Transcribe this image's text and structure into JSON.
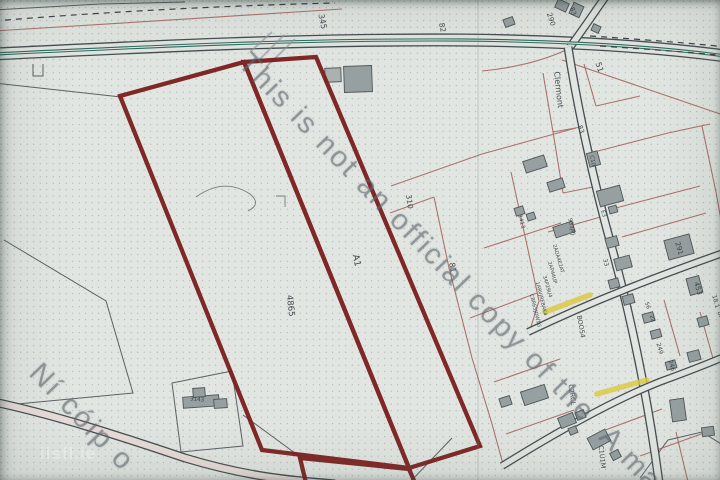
{
  "watermark": {
    "line1": "This is not an official copy of the",
    "line1_continued": "A ma",
    "line2": "Ní cóip o",
    "logo": "ilsfl.ie"
  },
  "map": {
    "colors": {
      "paper": "#e2e6e2",
      "dot": "#8a948c",
      "road_line": "#464d51",
      "road_center": "#2e6b5e",
      "road_inner_tint": "#e7dcd8",
      "property_line": "#a8655f",
      "thin_line": "#5b6165",
      "contour": "#757d80",
      "gray_mark": "#8f979b",
      "building_fill": "#97a0a1",
      "building_fill_light": "#aab1b0",
      "building_stroke": "#4e5558",
      "red_boundary": "#7b1e1d",
      "highlight": "#ddc83e",
      "label": "#323a3e",
      "dash_line": "#3a4043"
    },
    "roads": [
      {
        "name": "main-road",
        "d": "M -6,54 C 140,47 300,39 460,40 C 575,41 665,48 726,56",
        "w": 13
      },
      {
        "name": "top-branch-road",
        "d": "M 606,-4 C 596,10 584,28 570,47",
        "w": 8.5
      },
      {
        "name": "village-street",
        "d": "M 568,47 C 577,105 593,180 613,252 C 631,318 647,392 659,482",
        "w": 9
      },
      {
        "name": "upper-cross-street",
        "d": "M 528,332 C 595,300 655,277 726,252",
        "w": 8
      },
      {
        "name": "lower-cross-street",
        "d": "M 502,466 C 560,430 618,398 662,381 C 692,370 712,362 726,356",
        "w": 8
      },
      {
        "name": "bottom-left-road",
        "d": "M -6,402 C 60,416 125,438 185,458 C 245,476 285,480 335,484",
        "w": 9,
        "inner": "#e7dcd8"
      }
    ],
    "center_line": {
      "d": "M -6,54 C 140,47 300,39 460,40 C 575,41 665,48 726,56",
      "w": 3.2
    },
    "dashed_lines": [
      "M -6,21 C 90,13 210,6 335,3",
      "M 590,36 C 650,40 700,44 726,47",
      "M 600,46 C 660,50 700,53 726,56"
    ],
    "thin_lines": [
      "M -6,83 L 121,97",
      "M 4,240 L 106,301 L 133,393 L -4,406",
      "M 172,383 L 232,371 L 243,446 L 181,452 Z",
      "M 243,415 L 299,456",
      "M 410,482 L 452,438",
      "M 640,478 L 668,440 L 702,432 L 726,447",
      "M -6,10 L 100,4 L 185,2",
      "M 31,57 L 31,46 L 42,46 L 42,57",
      "M 33,64 L 33,76 L 43,76 L 43,64"
    ],
    "contour_lines": [
      "M 196,197 Q 224,177 250,194 Q 262,204 248,211",
      "M 276,196 L 285,196 L 285,207"
    ],
    "pink_lines": [
      "M -6,31 C 100,25 230,16 342,9",
      "M 390,213 L 434,197",
      "M 434,197 L 449,268 L 472,358 L 492,424 L 503,464",
      "M 391,186 L 482,154 L 576,128",
      "M 566,50 C 540,62 512,68 482,71",
      "M 543,73 L 553,132 L 563,193",
      "M 553,132 L 581,127",
      "M 563,193 L 598,186",
      "M 511,172 L 525,236 L 539,301 L 529,333",
      "M 470,318 L 537,293",
      "M 484,248 L 561,223",
      "M 598,151 L 668,133 L 710,124",
      "M 612,209 L 700,186",
      "M 622,237 L 706,213",
      "M 702,126 L 716,192 L 726,248",
      "M 664,300 L 680,356",
      "M 700,312 L 714,362",
      "M 494,382 L 560,359",
      "M 506,434 L 574,410",
      "M 600,432 L 662,409",
      "M 640,456 L 704,433",
      "M 676,432 L 688,482",
      "M 548,232 L 604,216",
      "M 584,64 L 596,106",
      "M 596,106 L 640,96",
      "M 562,60 L 726,116"
    ],
    "gray_marks": [
      "M 256,63 L 284,35",
      "M 266,67 L 295,39",
      "M 250,52 L 272,32"
    ],
    "red_boundary": {
      "width": 4.3,
      "polygons": [
        "120,96 244,62 409,468 262,450",
        "244,62 316,57 480,446 409,468",
        "300,458 409,469 415,483 306,483"
      ]
    },
    "yellow_highlights": [
      "M 545,312 L 590,295",
      "M 597,394 L 647,380"
    ],
    "buildings": [
      [
        325,
        68,
        16,
        14,
        -2,
        1
      ],
      [
        344,
        66,
        28,
        26,
        -2,
        0
      ],
      [
        556,
        1,
        12,
        9,
        25,
        0
      ],
      [
        571,
        4,
        11,
        12,
        25,
        0
      ],
      [
        592,
        25,
        8,
        7,
        25,
        0
      ],
      [
        504,
        18,
        10,
        8,
        -20,
        0
      ],
      [
        524,
        158,
        22,
        12,
        -18,
        0
      ],
      [
        588,
        152,
        11,
        14,
        -15,
        0
      ],
      [
        548,
        180,
        16,
        10,
        -18,
        0
      ],
      [
        598,
        188,
        24,
        16,
        -15,
        0
      ],
      [
        609,
        206,
        8,
        7,
        -15,
        0
      ],
      [
        515,
        207,
        9,
        8,
        -18,
        0
      ],
      [
        527,
        213,
        8,
        7,
        -18,
        0
      ],
      [
        554,
        224,
        20,
        11,
        -18,
        0
      ],
      [
        606,
        237,
        12,
        10,
        -15,
        0
      ],
      [
        615,
        257,
        16,
        12,
        -15,
        0
      ],
      [
        609,
        279,
        10,
        9,
        -15,
        0
      ],
      [
        623,
        295,
        11,
        9,
        -15,
        0
      ],
      [
        666,
        237,
        26,
        20,
        -15,
        0
      ],
      [
        688,
        277,
        13,
        17,
        -15,
        0
      ],
      [
        698,
        317,
        10,
        9,
        -15,
        0
      ],
      [
        643,
        313,
        11,
        9,
        -15,
        0
      ],
      [
        651,
        330,
        10,
        8,
        -15,
        0
      ],
      [
        688,
        351,
        12,
        10,
        -15,
        0
      ],
      [
        666,
        361,
        10,
        8,
        -15,
        0
      ],
      [
        522,
        388,
        25,
        14,
        -18,
        0
      ],
      [
        500,
        397,
        11,
        9,
        -18,
        0
      ],
      [
        559,
        415,
        16,
        11,
        -22,
        0
      ],
      [
        576,
        411,
        9,
        8,
        -22,
        0
      ],
      [
        569,
        427,
        8,
        7,
        -22,
        0
      ],
      [
        589,
        433,
        20,
        13,
        -28,
        0
      ],
      [
        611,
        451,
        9,
        8,
        -28,
        0
      ],
      [
        671,
        399,
        14,
        22,
        -8,
        0
      ],
      [
        702,
        427,
        12,
        9,
        -8,
        0
      ],
      [
        183,
        396,
        36,
        11,
        -4,
        0
      ],
      [
        193,
        388,
        12,
        9,
        -4,
        0
      ],
      [
        214,
        399,
        13,
        9,
        -4,
        0
      ]
    ],
    "labels": [
      {
        "t": "345",
        "x": 320,
        "y": 22,
        "r": 78,
        "s": 8
      },
      {
        "t": "82",
        "x": 440,
        "y": 28,
        "r": 78,
        "s": 7.5
      },
      {
        "t": "290",
        "x": 549,
        "y": 20,
        "r": 72,
        "s": 7
      },
      {
        "t": "83",
        "x": 571,
        "y": 12,
        "r": 72,
        "s": 6.5
      },
      {
        "t": "51",
        "x": 597,
        "y": 68,
        "r": 72,
        "s": 8
      },
      {
        "t": "Clermont",
        "x": 556,
        "y": 90,
        "r": 84,
        "s": 8
      },
      {
        "t": "83",
        "x": 579,
        "y": 130,
        "r": 72,
        "s": 6.5
      },
      {
        "t": "C10",
        "x": 591,
        "y": 161,
        "r": 80,
        "s": 5.5
      },
      {
        "t": "E3",
        "x": 602,
        "y": 214,
        "r": 75,
        "s": 5.5
      },
      {
        "t": "310",
        "x": 407,
        "y": 202,
        "r": 82,
        "s": 7.5
      },
      {
        "t": "81",
        "x": 450,
        "y": 268,
        "r": 80,
        "s": 8
      },
      {
        "t": "A1",
        "x": 354,
        "y": 261,
        "r": 78,
        "s": 9
      },
      {
        "t": "4865",
        "x": 288,
        "y": 306,
        "r": 84,
        "s": 8.5
      },
      {
        "t": "3143",
        "x": 197,
        "y": 401,
        "r": 5,
        "s": 5.5
      },
      {
        "t": "1413",
        "x": 520,
        "y": 222,
        "r": 75,
        "s": 5.5
      },
      {
        "t": "933JPJ",
        "x": 570,
        "y": 227,
        "r": 78,
        "s": 5.5
      },
      {
        "t": "2ADA4E2AT",
        "x": 557,
        "y": 259,
        "r": 74,
        "s": 5
      },
      {
        "t": "2AP44UP",
        "x": 551,
        "y": 273,
        "r": 74,
        "s": 5
      },
      {
        "t": "34P29U4",
        "x": 546,
        "y": 287,
        "r": 74,
        "s": 5
      },
      {
        "t": "1ARVJREBAK4",
        "x": 540,
        "y": 299,
        "r": 76,
        "s": 5
      },
      {
        "t": "CBRE5JDW1G",
        "x": 534,
        "y": 311,
        "r": 76,
        "s": 5
      },
      {
        "t": "BOO54",
        "x": 579,
        "y": 327,
        "r": 80,
        "s": 6.5
      },
      {
        "t": "33",
        "x": 604,
        "y": 263,
        "r": 75,
        "s": 6
      },
      {
        "t": "56",
        "x": 646,
        "y": 306,
        "r": 72,
        "s": 5.5
      },
      {
        "t": "22",
        "x": 651,
        "y": 319,
        "r": 72,
        "s": 5.5
      },
      {
        "t": "249",
        "x": 658,
        "y": 349,
        "r": 74,
        "s": 6
      },
      {
        "t": "246",
        "x": 670,
        "y": 366,
        "r": 74,
        "s": 6
      },
      {
        "t": "291",
        "x": 677,
        "y": 249,
        "r": 74,
        "s": 7
      },
      {
        "t": "453",
        "x": 696,
        "y": 289,
        "r": 74,
        "s": 7
      },
      {
        "t": "18.1",
        "x": 714,
        "y": 302,
        "r": 74,
        "s": 6
      },
      {
        "t": "BM26",
        "x": 720,
        "y": 320,
        "r": 74,
        "s": 6
      },
      {
        "t": "C2RCL",
        "x": 570,
        "y": 395,
        "r": 82,
        "s": 6.5
      },
      {
        "t": "C1U1M",
        "x": 600,
        "y": 457,
        "r": 84,
        "s": 6.5
      }
    ]
  }
}
